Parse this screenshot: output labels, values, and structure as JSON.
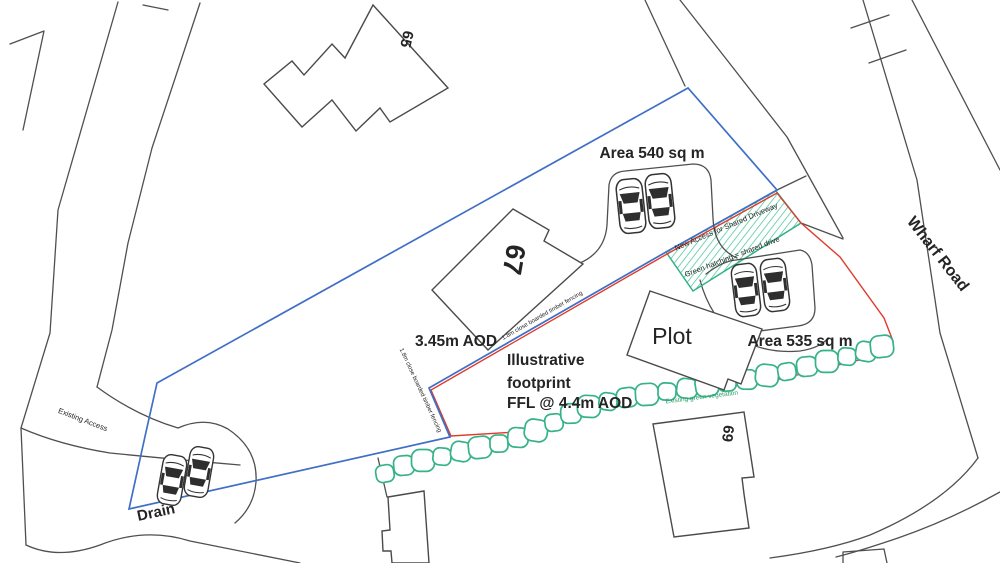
{
  "plan": {
    "houses": {
      "h65": "65",
      "h67": "67",
      "h69": "69"
    },
    "areas": {
      "north": "Area 540 sq m",
      "south": "Area 535 sq m"
    },
    "roads": {
      "wharf": "Wharf Road",
      "existing_access": "Existing Access",
      "drain": "Drain"
    },
    "plot": {
      "label": "Plot",
      "footprint_line1": "Illustrative",
      "footprint_line2": "footprint",
      "ffl": "FFL @ 4.4m AOD",
      "level": "3.45m AOD"
    },
    "annotations": {
      "new_access": "New Access for Shared Driveway",
      "hatch_note": "Green hatching = shared drive",
      "vegetation": "Existing green vegetation",
      "fence_diagonal": "1.8m close boarded timber fencing",
      "fence_west": "1.8m close boarded timber fencing"
    },
    "colors": {
      "boundary-blue": "#3f6fc6",
      "boundary-red": "#df3b2c",
      "hedge-green": "#35b289",
      "veg-green": "#35a06b",
      "line-gray": "#4f4f4f",
      "text-dark": "#242424"
    }
  }
}
